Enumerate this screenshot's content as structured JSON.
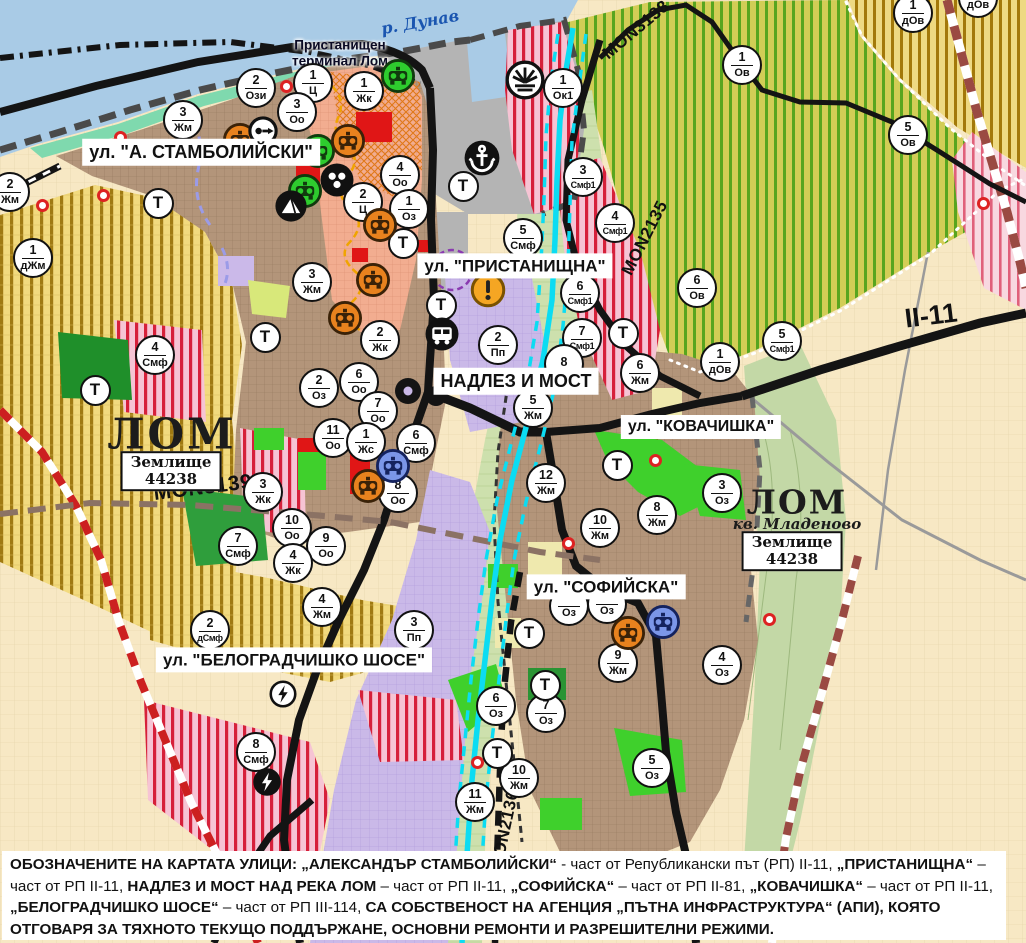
{
  "palette": {
    "marker_ring": "#111111",
    "marker_bg": "#ffffff",
    "street_label_bg": "#ffffff",
    "river_label": "#1a55b0",
    "water": "#a9cbe6",
    "river_lom": "#0cdcf2",
    "urban_brown": "#b3957a",
    "industrial_purple": "#cab9e8",
    "park_green": "#3fd02c",
    "smf_pink_stripe": "#d6203a",
    "orchard_green_stripe": "#58a51f",
    "farmland_cream": "#f7e8c4",
    "road_black": "#141414",
    "railway_maroon": "#9a4a42",
    "monument_orange": "#e8821e",
    "monument_green": "#2ecc2e",
    "monument_blue": "#7b96e8",
    "warning_orange": "#f5a623",
    "red_dot": "#dd2222"
  },
  "map": {
    "t_label": "Т",
    "labels": [
      {
        "type": "street",
        "text": "ул. \"А. СТАМБОЛИЙСКИ\"",
        "x": 201,
        "y": 152,
        "fs": 18
      },
      {
        "type": "street",
        "text": "ул. \"ПРИСТАНИЩНА\"",
        "x": 515,
        "y": 266,
        "fs": 17
      },
      {
        "type": "street",
        "text": "НАДЛЕЗ И МОСТ",
        "x": 516,
        "y": 381,
        "fs": 18
      },
      {
        "type": "street",
        "text": "ул. \"КОВАЧИШКА\"",
        "x": 701,
        "y": 427,
        "fs": 16
      },
      {
        "type": "street",
        "text": "ул. \"СОФИЙСКА\"",
        "x": 606,
        "y": 587,
        "fs": 17
      },
      {
        "type": "street",
        "text": "ул. \"БЕЛОГРАДЧИШКО ШОСЕ\"",
        "x": 294,
        "y": 660,
        "fs": 17
      },
      {
        "type": "river",
        "text": "р. Дунав",
        "x": 420,
        "y": 22,
        "rot": -10
      },
      {
        "type": "port",
        "lines": [
          "Пристанищен",
          "терминал Лом"
        ],
        "x": 340,
        "y": 53
      },
      {
        "type": "city",
        "text": "ЛОМ",
        "x": 172,
        "y": 434
      },
      {
        "type": "landbox",
        "lines": [
          "Землище",
          "44238"
        ],
        "x": 171,
        "y": 471
      },
      {
        "type": "city2",
        "text": "ЛОМ",
        "x": 797,
        "y": 502
      },
      {
        "type": "suburb",
        "text": "кв. Младеново",
        "x": 797,
        "y": 524
      },
      {
        "type": "landbox",
        "lines": [
          "Землище",
          "44238"
        ],
        "x": 792,
        "y": 551
      },
      {
        "type": "road",
        "text": "MON3139",
        "x": 203,
        "y": 488,
        "rot": -7,
        "fs": 21
      },
      {
        "type": "road",
        "text": "MON2135",
        "x": 645,
        "y": 238,
        "rot": -63,
        "fs": 17
      },
      {
        "type": "road",
        "text": "MON3138",
        "x": 636,
        "y": 30,
        "rot": -40,
        "fs": 17
      },
      {
        "type": "road",
        "text": "MON2136",
        "x": 505,
        "y": 830,
        "rot": -78,
        "fs": 17
      },
      {
        "type": "roadbig",
        "text": "II-11",
        "x": 931,
        "y": 316,
        "rot": -7,
        "fs": 27
      }
    ],
    "zone_markers": [
      {
        "x": 256,
        "y": 88,
        "n": "2",
        "c": "Ози"
      },
      {
        "x": 313,
        "y": 83,
        "n": "1",
        "c": "Ц"
      },
      {
        "x": 364,
        "y": 91,
        "n": "1",
        "c": "Жк"
      },
      {
        "x": 297,
        "y": 112,
        "n": "3",
        "c": "Оо"
      },
      {
        "x": 563,
        "y": 88,
        "n": "1",
        "c": "Ок1"
      },
      {
        "x": 742,
        "y": 65,
        "n": "1",
        "c": "Ов"
      },
      {
        "x": 913,
        "y": 13,
        "n": "1",
        "c": "дОв"
      },
      {
        "x": 978,
        "y": -2,
        "n": "",
        "c": "дОв"
      },
      {
        "x": 908,
        "y": 135,
        "n": "5",
        "c": "Ов"
      },
      {
        "x": 10,
        "y": 192,
        "n": "2",
        "c": "Жм"
      },
      {
        "x": 183,
        "y": 120,
        "n": "3",
        "c": "Жм"
      },
      {
        "x": 33,
        "y": 258,
        "n": "1",
        "c": "дЖм"
      },
      {
        "x": 400,
        "y": 175,
        "n": "4",
        "c": "Оо"
      },
      {
        "x": 363,
        "y": 202,
        "n": "2",
        "c": "Ц"
      },
      {
        "x": 409,
        "y": 209,
        "n": "1",
        "c": "Оз"
      },
      {
        "x": 583,
        "y": 177,
        "n": "3",
        "c": "Смф1"
      },
      {
        "x": 615,
        "y": 223,
        "n": "4",
        "c": "Смф1"
      },
      {
        "x": 523,
        "y": 238,
        "n": "5",
        "c": "Смф"
      },
      {
        "x": 580,
        "y": 293,
        "n": "6",
        "c": "Смф1"
      },
      {
        "x": 582,
        "y": 338,
        "n": "7",
        "c": "Смф1"
      },
      {
        "x": 697,
        "y": 288,
        "n": "6",
        "c": "Ов"
      },
      {
        "x": 782,
        "y": 341,
        "n": "5",
        "c": "Смф1"
      },
      {
        "x": 720,
        "y": 362,
        "n": "1",
        "c": "дОв"
      },
      {
        "x": 640,
        "y": 373,
        "n": "6",
        "c": "Жм"
      },
      {
        "x": 564,
        "y": 364,
        "n": "8",
        "c": ""
      },
      {
        "x": 533,
        "y": 408,
        "n": "5",
        "c": "Жм"
      },
      {
        "x": 312,
        "y": 282,
        "n": "3",
        "c": "Жм"
      },
      {
        "x": 380,
        "y": 340,
        "n": "2",
        "c": "Жк"
      },
      {
        "x": 359,
        "y": 382,
        "n": "6",
        "c": "Оо"
      },
      {
        "x": 319,
        "y": 388,
        "n": "2",
        "c": "Оз"
      },
      {
        "x": 378,
        "y": 411,
        "n": "7",
        "c": "Оо"
      },
      {
        "x": 333,
        "y": 438,
        "n": "11",
        "c": "Оо"
      },
      {
        "x": 366,
        "y": 442,
        "n": "1",
        "c": "Жс"
      },
      {
        "x": 416,
        "y": 443,
        "n": "6",
        "c": "Смф"
      },
      {
        "x": 398,
        "y": 493,
        "n": "8",
        "c": "Оо"
      },
      {
        "x": 263,
        "y": 492,
        "n": "3",
        "c": "Жк"
      },
      {
        "x": 155,
        "y": 355,
        "n": "4",
        "c": "Смф"
      },
      {
        "x": 292,
        "y": 528,
        "n": "10",
        "c": "Оо"
      },
      {
        "x": 326,
        "y": 546,
        "n": "9",
        "c": "Оо"
      },
      {
        "x": 293,
        "y": 563,
        "n": "4",
        "c": "Жк"
      },
      {
        "x": 238,
        "y": 546,
        "n": "7",
        "c": "Смф"
      },
      {
        "x": 546,
        "y": 483,
        "n": "12",
        "c": "Жм"
      },
      {
        "x": 600,
        "y": 528,
        "n": "10",
        "c": "Жм"
      },
      {
        "x": 657,
        "y": 515,
        "n": "8",
        "c": "Жм"
      },
      {
        "x": 722,
        "y": 493,
        "n": "3",
        "c": "Оз"
      },
      {
        "x": 322,
        "y": 607,
        "n": "4",
        "c": "Жм"
      },
      {
        "x": 414,
        "y": 630,
        "n": "3",
        "c": "Пп"
      },
      {
        "x": 210,
        "y": 630,
        "n": "2",
        "c": "дСмф"
      },
      {
        "x": 498,
        "y": 345,
        "n": "2",
        "c": "Пп"
      },
      {
        "x": 256,
        "y": 752,
        "n": "8",
        "c": "Смф"
      },
      {
        "x": 618,
        "y": 663,
        "n": "9",
        "c": "Жм"
      },
      {
        "x": 722,
        "y": 665,
        "n": "4",
        "c": "Оз"
      },
      {
        "x": 496,
        "y": 706,
        "n": "6",
        "c": "Оз"
      },
      {
        "x": 546,
        "y": 713,
        "n": "7",
        "c": "Оз"
      },
      {
        "x": 652,
        "y": 768,
        "n": "5",
        "c": "Оз"
      },
      {
        "x": 519,
        "y": 778,
        "n": "10",
        "c": "Жм"
      },
      {
        "x": 475,
        "y": 802,
        "n": "11",
        "c": "Жм"
      },
      {
        "x": 569,
        "y": 606,
        "n": "",
        "c": "Оз"
      },
      {
        "x": 607,
        "y": 604,
        "n": "",
        "c": "Оз"
      }
    ],
    "t_markers": [
      {
        "x": 158,
        "y": 203
      },
      {
        "x": 463,
        "y": 186
      },
      {
        "x": 403,
        "y": 243
      },
      {
        "x": 441,
        "y": 305
      },
      {
        "x": 265,
        "y": 337
      },
      {
        "x": 95,
        "y": 390
      },
      {
        "x": 623,
        "y": 333
      },
      {
        "x": 617,
        "y": 465
      },
      {
        "x": 529,
        "y": 633
      },
      {
        "x": 545,
        "y": 685
      },
      {
        "x": 497,
        "y": 753
      }
    ],
    "icons": [
      {
        "x": 398,
        "y": 76,
        "type": "green-monument-icon"
      },
      {
        "x": 318,
        "y": 151,
        "type": "green-monument-icon"
      },
      {
        "x": 305,
        "y": 191,
        "type": "green-monument-icon"
      },
      {
        "x": 240,
        "y": 140,
        "type": "orange-monument-icon"
      },
      {
        "x": 348,
        "y": 141,
        "type": "orange-monument-icon"
      },
      {
        "x": 380,
        "y": 225,
        "type": "orange-monument-icon"
      },
      {
        "x": 373,
        "y": 280,
        "type": "orange-monument-icon"
      },
      {
        "x": 345,
        "y": 318,
        "type": "orange-monument-icon"
      },
      {
        "x": 368,
        "y": 486,
        "type": "orange-monument-icon"
      },
      {
        "x": 628,
        "y": 633,
        "type": "orange-monument-icon"
      },
      {
        "x": 393,
        "y": 466,
        "type": "blue-monument-icon"
      },
      {
        "x": 663,
        "y": 622,
        "type": "blue-monument-icon"
      },
      {
        "x": 482,
        "y": 158,
        "type": "anchor-icon"
      },
      {
        "x": 263,
        "y": 131,
        "type": "arrow-icon"
      },
      {
        "x": 337,
        "y": 180,
        "type": "people-icon"
      },
      {
        "x": 291,
        "y": 206,
        "type": "mountain-icon"
      },
      {
        "x": 442,
        "y": 334,
        "type": "bus-icon"
      },
      {
        "x": 525,
        "y": 80,
        "type": "sunburst-icon"
      },
      {
        "x": 488,
        "y": 290,
        "type": "warning-icon"
      },
      {
        "x": 283,
        "y": 694,
        "type": "lightning-icon"
      },
      {
        "x": 267,
        "y": 782,
        "type": "lightning-dark-icon"
      }
    ],
    "red_dots": [
      {
        "x": 42,
        "y": 205
      },
      {
        "x": 103,
        "y": 195
      },
      {
        "x": 120,
        "y": 137
      },
      {
        "x": 983,
        "y": 203
      },
      {
        "x": 655,
        "y": 460
      },
      {
        "x": 568,
        "y": 543
      },
      {
        "x": 769,
        "y": 619
      },
      {
        "x": 477,
        "y": 762
      },
      {
        "x": 286,
        "y": 86
      }
    ]
  },
  "footnote": {
    "segments": [
      {
        "b": 1,
        "t": "ОБОЗНАЧЕНИТЕ НА КАРТАТА УЛИЦИ: „АЛЕКСАНДЪР СТАМБОЛИЙСКИ“"
      },
      {
        "b": 0,
        "t": " - част от Републикански път (РП) II-11, "
      },
      {
        "b": 1,
        "t": "„ПРИСТАНИЩНА“"
      },
      {
        "b": 0,
        "t": " – част от РП II-11, "
      },
      {
        "b": 1,
        "t": "НАДЛЕЗ И МОСТ НАД РЕКА ЛОМ"
      },
      {
        "b": 0,
        "t": " – част от РП II-11, "
      },
      {
        "b": 1,
        "t": "„СОФИЙСКА“"
      },
      {
        "b": 0,
        "t": " – част от РП II-81, "
      },
      {
        "b": 1,
        "t": "„КОВАЧИШКА“"
      },
      {
        "b": 0,
        "t": " – част от РП II-11, "
      },
      {
        "b": 1,
        "t": "„БЕЛОГРАДЧИШКО ШОСЕ“"
      },
      {
        "b": 0,
        "t": " – част от РП III-114, "
      },
      {
        "b": 1,
        "t": "СА СОБСТВЕНОСТ НА АГЕНЦИЯ „ПЪТНА ИНФРАСТРУКТУРА“ (АПИ), КОЯТО ОТГОВАРЯ ЗА ТЯХНОТО ТЕКУЩО ПОДДЪРЖАНЕ, ОСНОВНИ РЕМОНТИ И РАЗРЕШИТЕЛНИ РЕЖИМИ."
      }
    ]
  }
}
